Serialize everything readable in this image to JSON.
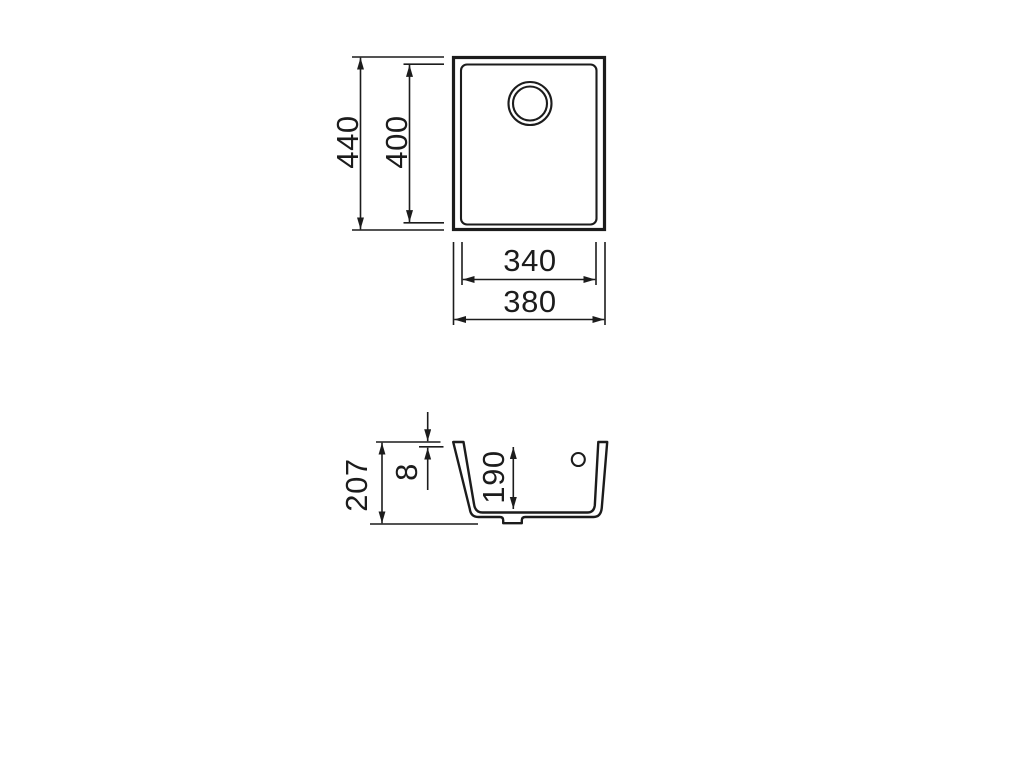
{
  "page": {
    "background": "#ffffff"
  },
  "drawing": {
    "line_color": "#1c1c1c",
    "top_view": {
      "overall_height": "440",
      "inner_height": "400",
      "inner_width": "340",
      "overall_width": "380"
    },
    "section_view": {
      "overall_height": "207",
      "rim_thickness": "8",
      "bowl_depth": "190"
    }
  }
}
